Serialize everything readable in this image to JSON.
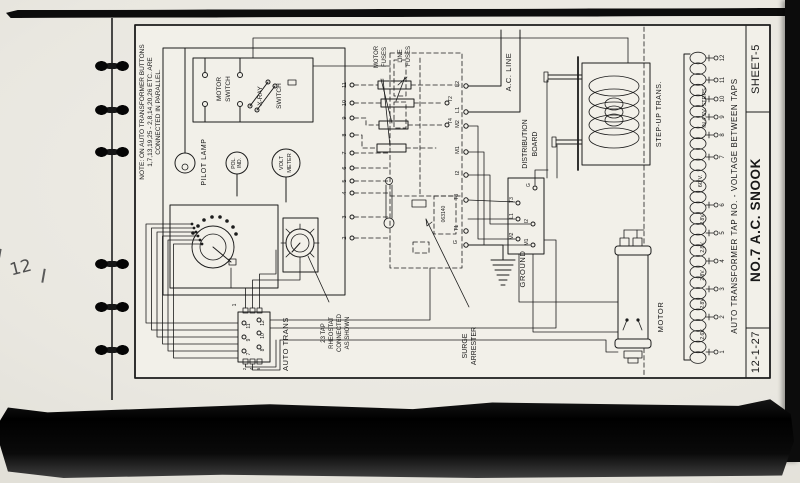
{
  "page": {
    "handwriting": "12",
    "titleblock": {
      "sheet": "SHEET-5",
      "title": "NO.7 A.C. SNOOK",
      "date": "12-1-27"
    }
  },
  "note": {
    "l1": "NOTE: ON AUTO TRANSFORMER BUTTONS",
    "l2": "1,7,13,19,25 - 2,8,14,20,26 ETC. ARE",
    "l3": "CONNECTED IN PARALLEL."
  },
  "labels": {
    "pilot_lamp": "PILOT LAMP",
    "motor_sw1": "MOTOR",
    "motor_sw2": "SWITCH",
    "xray1": "X-RAY",
    "xray2": "SWITCH",
    "pol1": "POL.",
    "pol2": "IND.",
    "volt1": "VOLT",
    "volt2": "METER",
    "motor_fuses1": "MOTOR",
    "motor_fuses2": "FUSES",
    "line_fuses1": "LINE",
    "line_fuses2": "FUSES",
    "ac_line": "A.C. LINE",
    "dist1": "DISTRIBUTION",
    "dist2": "BOARD",
    "step_up": "STEP-UP TRANS.",
    "auto_trans": "AUTO TRANS",
    "rheo1": "23 TAP",
    "rheo2": "RHEOSTAT",
    "rheo3": "CONNECTED",
    "rheo4": "AS SHOWN",
    "surge1": "SURGE",
    "surge2": "ARRESTER",
    "ground": "GROUND",
    "motor_unit": "MOTOR",
    "part_no": "063140",
    "winding_caption": "AUTO TRANSFORMER TAP NO. - VOLTAGE BETWEEN TAPS"
  },
  "panel_terminals": [
    "L2",
    "L1",
    "M2",
    "M1",
    "I2",
    "T3",
    "T1",
    "G"
  ],
  "tap_contacts": {
    "t2": "T2",
    "t4": "T4"
  },
  "row_numbers": [
    "11",
    "10",
    "9",
    "8",
    "7",
    "6",
    "5",
    "4",
    "3",
    "2"
  ],
  "dist_terminals": [
    "G",
    "T3",
    "L1",
    "I2",
    "M2",
    "M1"
  ],
  "autotrans_terminals": {
    "top": "1",
    "outer": [
      "11",
      "9",
      "7"
    ],
    "inner": [
      "12",
      "10",
      "8"
    ],
    "bottom": [
      "2",
      "4",
      "6"
    ]
  },
  "winding": {
    "taps": [
      "12",
      "11",
      "10",
      "9",
      "8",
      "7",
      "6",
      "5",
      "4",
      "3",
      "2",
      "1"
    ],
    "steps_note": "IN 4.5V. STEPS",
    "sixty": "60 V.",
    "voltages": [
      "2.8V.",
      "2.8V.",
      "2.8V.",
      "2.8V.",
      "2.6V."
    ]
  }
}
